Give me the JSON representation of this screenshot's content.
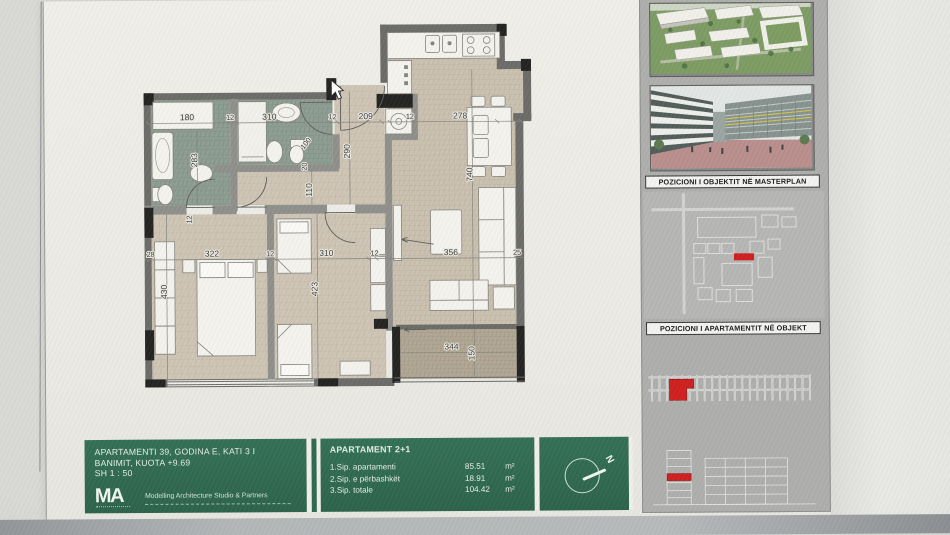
{
  "title_block": {
    "line1": "APARTAMENTI 39, GODINA E, KATI 3 I",
    "line2": "BANIMIT, KUOTA +9.69",
    "scale": "SH 1 : 50",
    "logo": "MA",
    "firm": "Modelling Architecture Studio & Partners",
    "green_color": "#2f6b51"
  },
  "apartment_table": {
    "header": "APARTAMENT 2+1",
    "rows": [
      {
        "label": "1.Sip. apartamenti",
        "value": "85.51",
        "unit": "m²"
      },
      {
        "label": "2.Sip. e përbashkët",
        "value": "18.91",
        "unit": "m²"
      },
      {
        "label": "3.Sip. totale",
        "value": "104.42",
        "unit": "m²"
      }
    ]
  },
  "sidebar": {
    "masterplan_label": "POZICIONI I OBJEKTIT NË MASTERPLAN",
    "apartment_label": "POZICIONI I APARTAMENTIT NË OBJEKT",
    "highlight_color": "#cf1f1f"
  },
  "compass": {
    "north": "N"
  },
  "plan": {
    "dims_top": [
      "180",
      "12",
      "310",
      "12",
      "209",
      "12",
      "278"
    ],
    "dims_mid": [
      "28",
      "322",
      "12",
      "310",
      "12",
      "356",
      "25"
    ],
    "dims_v": [
      "283",
      "290",
      "110",
      "430",
      "423",
      "740"
    ],
    "dims_small": [
      "100",
      "20",
      "12"
    ],
    "dims_balcony": [
      "344",
      "150"
    ]
  }
}
